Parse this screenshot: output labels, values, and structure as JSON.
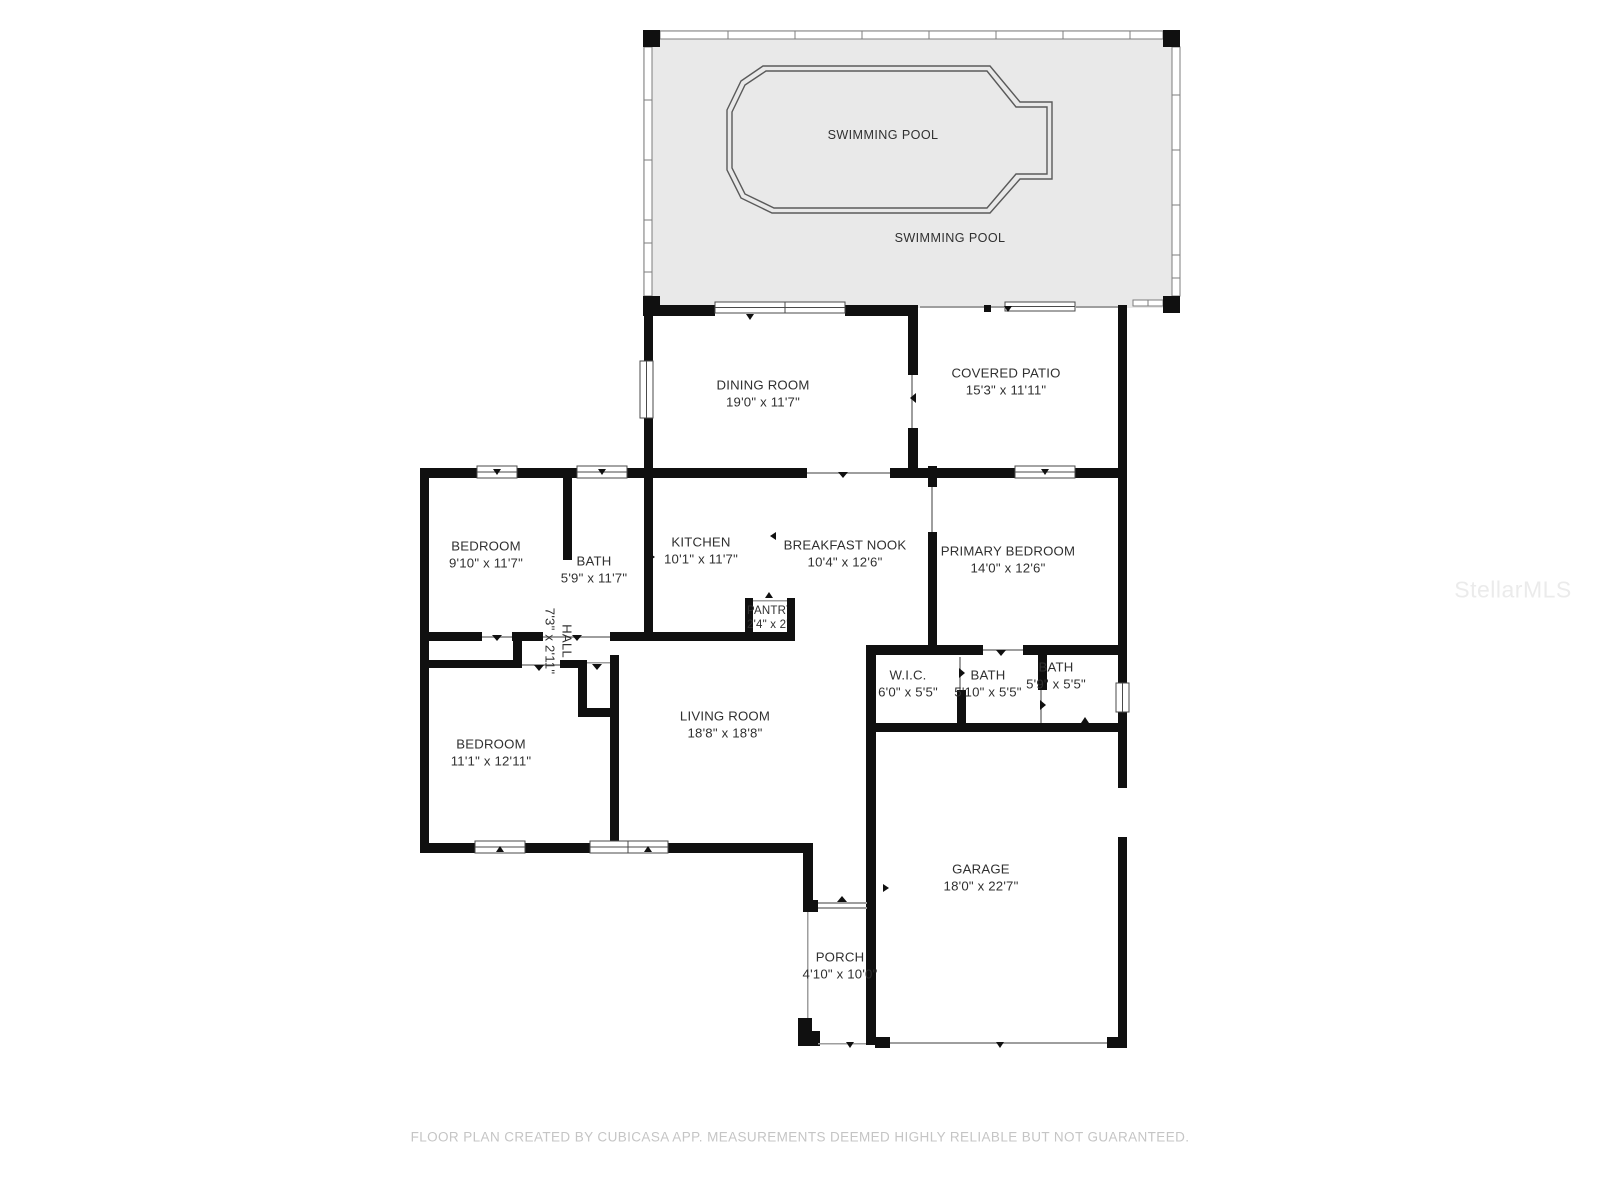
{
  "colors": {
    "wall": "#101010",
    "pool_deck": "#e9e9e9",
    "thin_line": "#9e9e9e",
    "window_border": "#4a4a4a",
    "screen_border": "#7d7d7d",
    "pool_outline": "#5a5a5a",
    "label_text": "#303030",
    "footer_text": "#c5c5c5",
    "watermark_text": "#ebebeb",
    "background": "#ffffff"
  },
  "pool": {
    "pool_label": "SWIMMING POOL",
    "deck_label": "SWIMMING POOL"
  },
  "rooms": {
    "dining_room": {
      "name": "DINING ROOM",
      "dims": "19'0\" x 11'7\""
    },
    "covered_patio": {
      "name": "COVERED PATIO",
      "dims": "15'3\" x 11'11\""
    },
    "bedroom_small": {
      "name": "BEDROOM",
      "dims": "9'10\" x 11'7\""
    },
    "bath_hall": {
      "name": "BATH",
      "dims": "5'9\" x 11'7\""
    },
    "kitchen": {
      "name": "KITCHEN",
      "dims": "10'1\" x 11'7\""
    },
    "pantry": {
      "name": "PANTRY",
      "dims": "2'4\" x 2'0\""
    },
    "breakfast_nook": {
      "name": "BREAKFAST NOOK",
      "dims": "10'4\" x 12'6\""
    },
    "primary_bedroom": {
      "name": "PRIMARY BEDROOM",
      "dims": "14'0\" x 12'6\""
    },
    "hall": {
      "name": "HALL",
      "dims": "7'3\" x 2'11\""
    },
    "wic": {
      "name": "W.I.C.",
      "dims": "6'0\" x 5'5\""
    },
    "bath_primary": {
      "name": "BATH",
      "dims": "5'10\" x 5'5\""
    },
    "bath_guest": {
      "name": "BATH",
      "dims": "5'9\" x 5'5\""
    },
    "living_room": {
      "name": "LIVING ROOM",
      "dims": "18'8\" x 18'8\""
    },
    "bedroom_large": {
      "name": "BEDROOM",
      "dims": "11'1\" x 12'11\""
    },
    "garage": {
      "name": "GARAGE",
      "dims": "18'0\" x 22'7\""
    },
    "porch": {
      "name": "PORCH",
      "dims": "4'10\" x 10'0\""
    }
  },
  "footer": {
    "text": "FLOOR PLAN CREATED BY CUBICASA APP. MEASUREMENTS DEEMED HIGHLY RELIABLE BUT NOT GUARANTEED."
  },
  "watermark": {
    "text": "StellarMLS"
  }
}
